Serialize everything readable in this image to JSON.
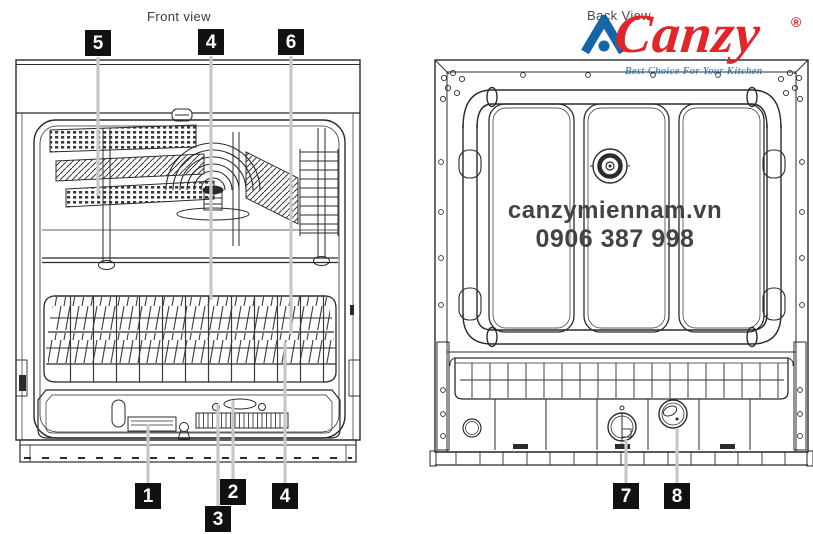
{
  "page": {
    "background": "#ffffff"
  },
  "views": {
    "front": {
      "title": "Front view"
    },
    "back": {
      "title": "Back View"
    }
  },
  "brand": {
    "name": "Canzy",
    "registered_mark": "®",
    "tagline": "Best Choice For Your Kitchen",
    "logo_mark": "triangle-a-with-dot",
    "color_red": "#e2242b",
    "color_blue": "#1565a8"
  },
  "watermark": {
    "website": "canzymiennam.vn",
    "phone": "0906 387 998",
    "color": "#434343"
  },
  "callouts": {
    "style": {
      "background": "#111111",
      "text_color": "#ffffff",
      "leader_color": "#c8c8c8"
    },
    "front_top": [
      "5",
      "4",
      "6"
    ],
    "front_bottom": [
      "1",
      "2",
      "3",
      "4"
    ],
    "back_bottom": [
      "7",
      "8"
    ]
  }
}
